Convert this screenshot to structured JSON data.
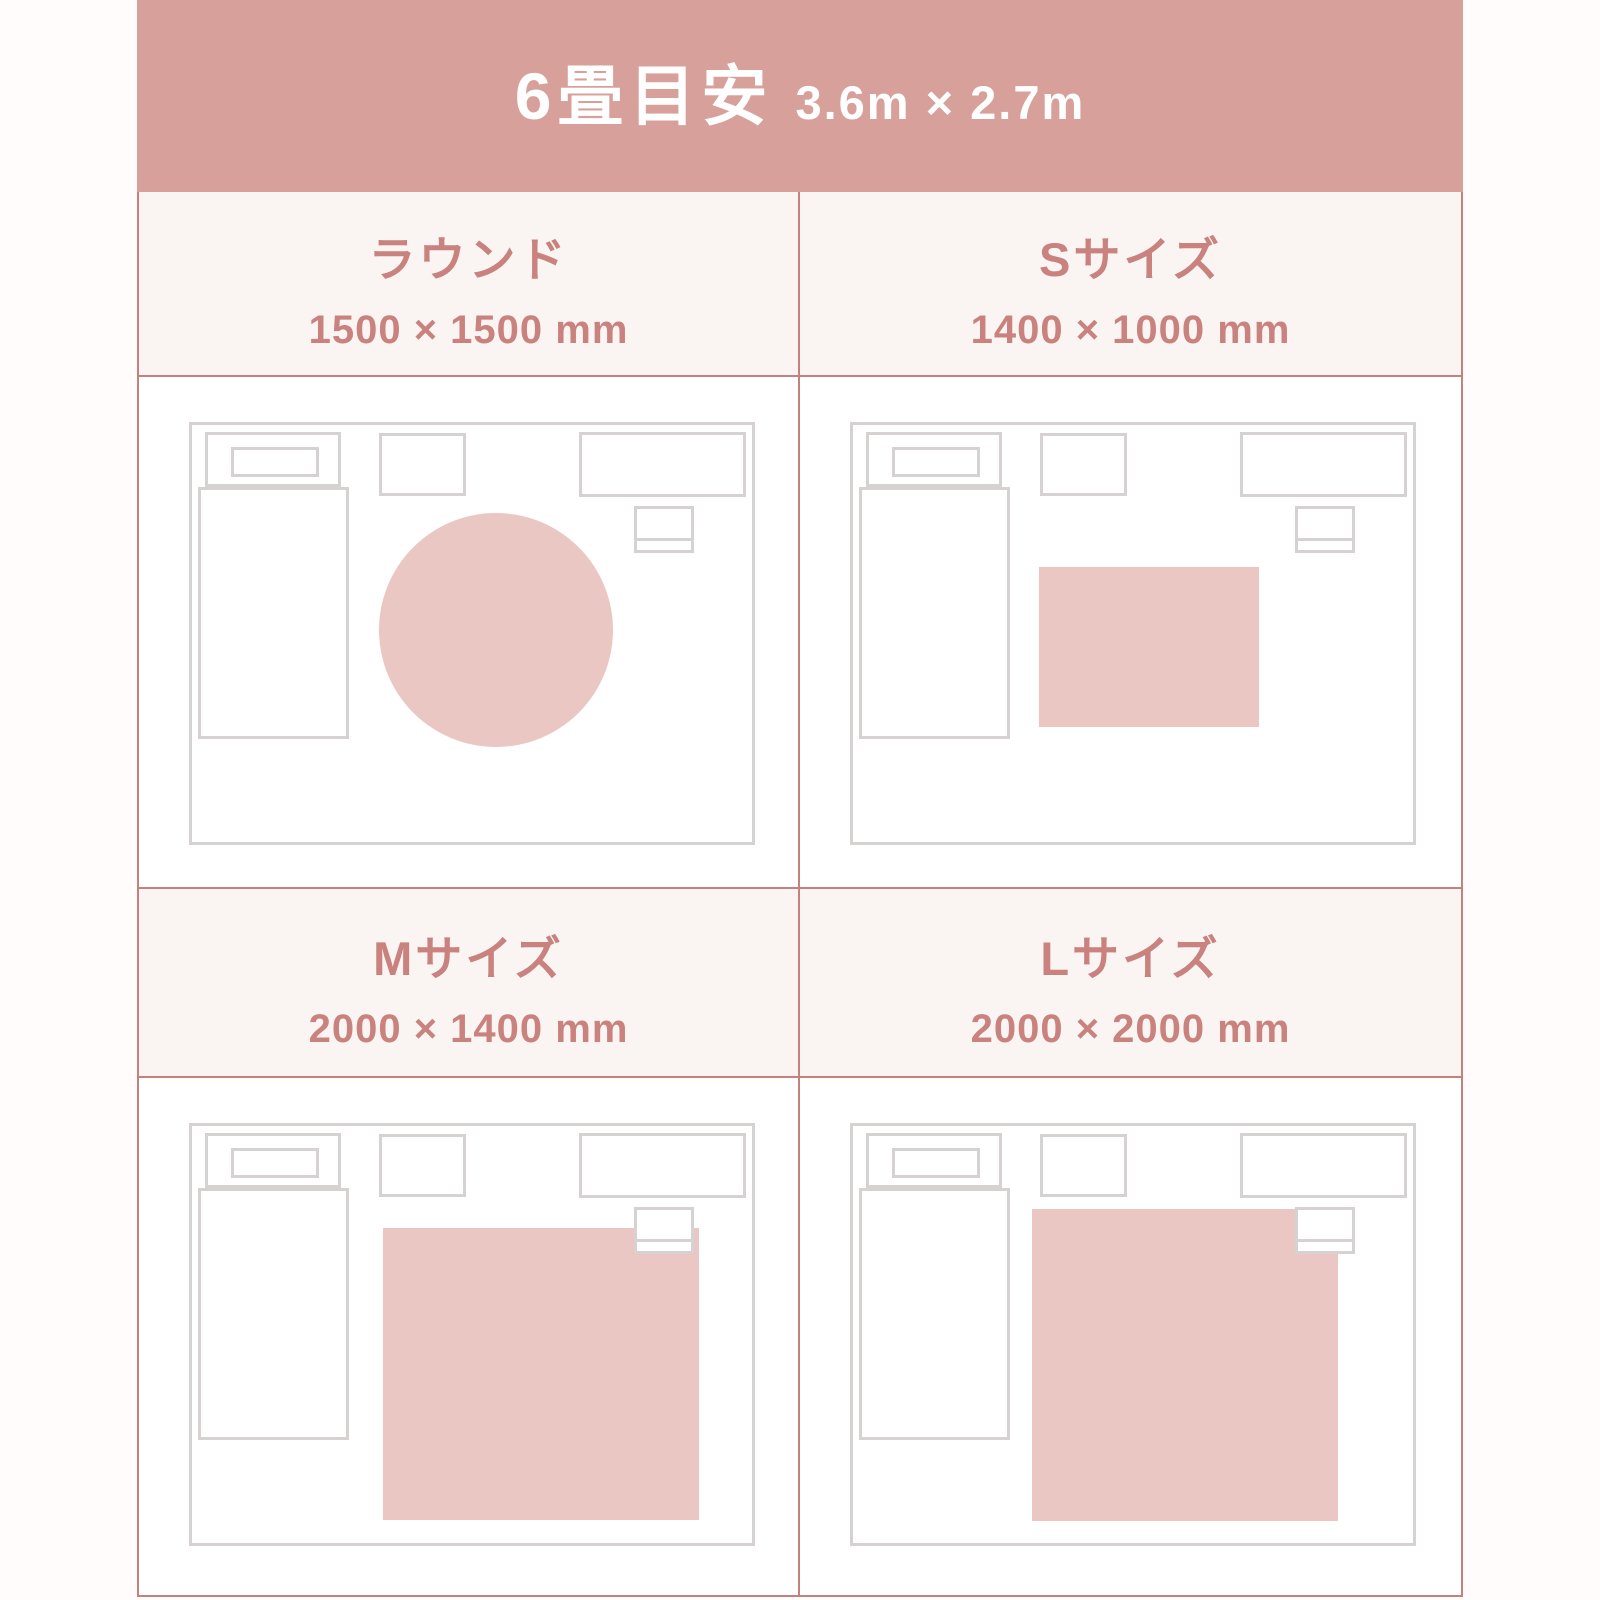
{
  "header": {
    "title": "6畳目安",
    "subtitle": "3.6m × 2.7m"
  },
  "cells": [
    {
      "id": "round",
      "title": "ラウンド",
      "dimensions": "1500 × 1500 mm",
      "rug_shape": "circle"
    },
    {
      "id": "s",
      "title": "Sサイズ",
      "dimensions": "1400 × 1000 mm",
      "rug_shape": "rect"
    },
    {
      "id": "m",
      "title": "Mサイズ",
      "dimensions": "2000 × 1400 mm",
      "rug_shape": "rect"
    },
    {
      "id": "l",
      "title": "Lサイズ",
      "dimensions": "2000 × 2000 mm",
      "rug_shape": "rect"
    }
  ],
  "colors": {
    "header_bg": "#d8a09a",
    "accent_text": "#c9827e",
    "grid_border": "#c5827c",
    "label_bg": "#faf5f3",
    "rug_fill": "#eac7c3",
    "furniture_line": "#d5d2d1",
    "page_bg": "#fffcfb"
  }
}
